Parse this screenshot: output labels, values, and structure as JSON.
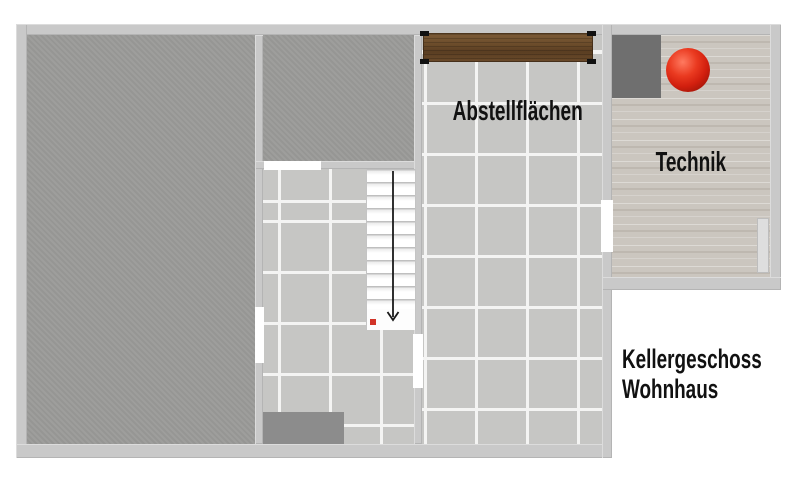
{
  "title": {
    "line1": "Kellergeschoss",
    "line2": "Wohnhaus"
  },
  "rooms": {
    "storage": {
      "label": "Abstellflächen"
    },
    "technik": {
      "label": "Technik"
    }
  },
  "icons": {
    "stair_arrow": "arrow-down",
    "stair_start_marker": "red-square",
    "expansion_tank": "red-sphere"
  },
  "colors": {
    "wall": "#c9c9c9",
    "concrete_floor": "#9b9b99",
    "tile_floor": "#c6c6c4",
    "tile_grout": "#f4f4f3",
    "screed_floor": "#cbc6bf",
    "wood_shelf": "#6e4e2c",
    "floor_mat": "#8c8c8c",
    "tech_unit": "#6f6f6f",
    "tank_red": "#d21f0e",
    "stair_marker_red": "#d23428",
    "arrow": "#1a1a1a",
    "label_text": "#111111"
  }
}
